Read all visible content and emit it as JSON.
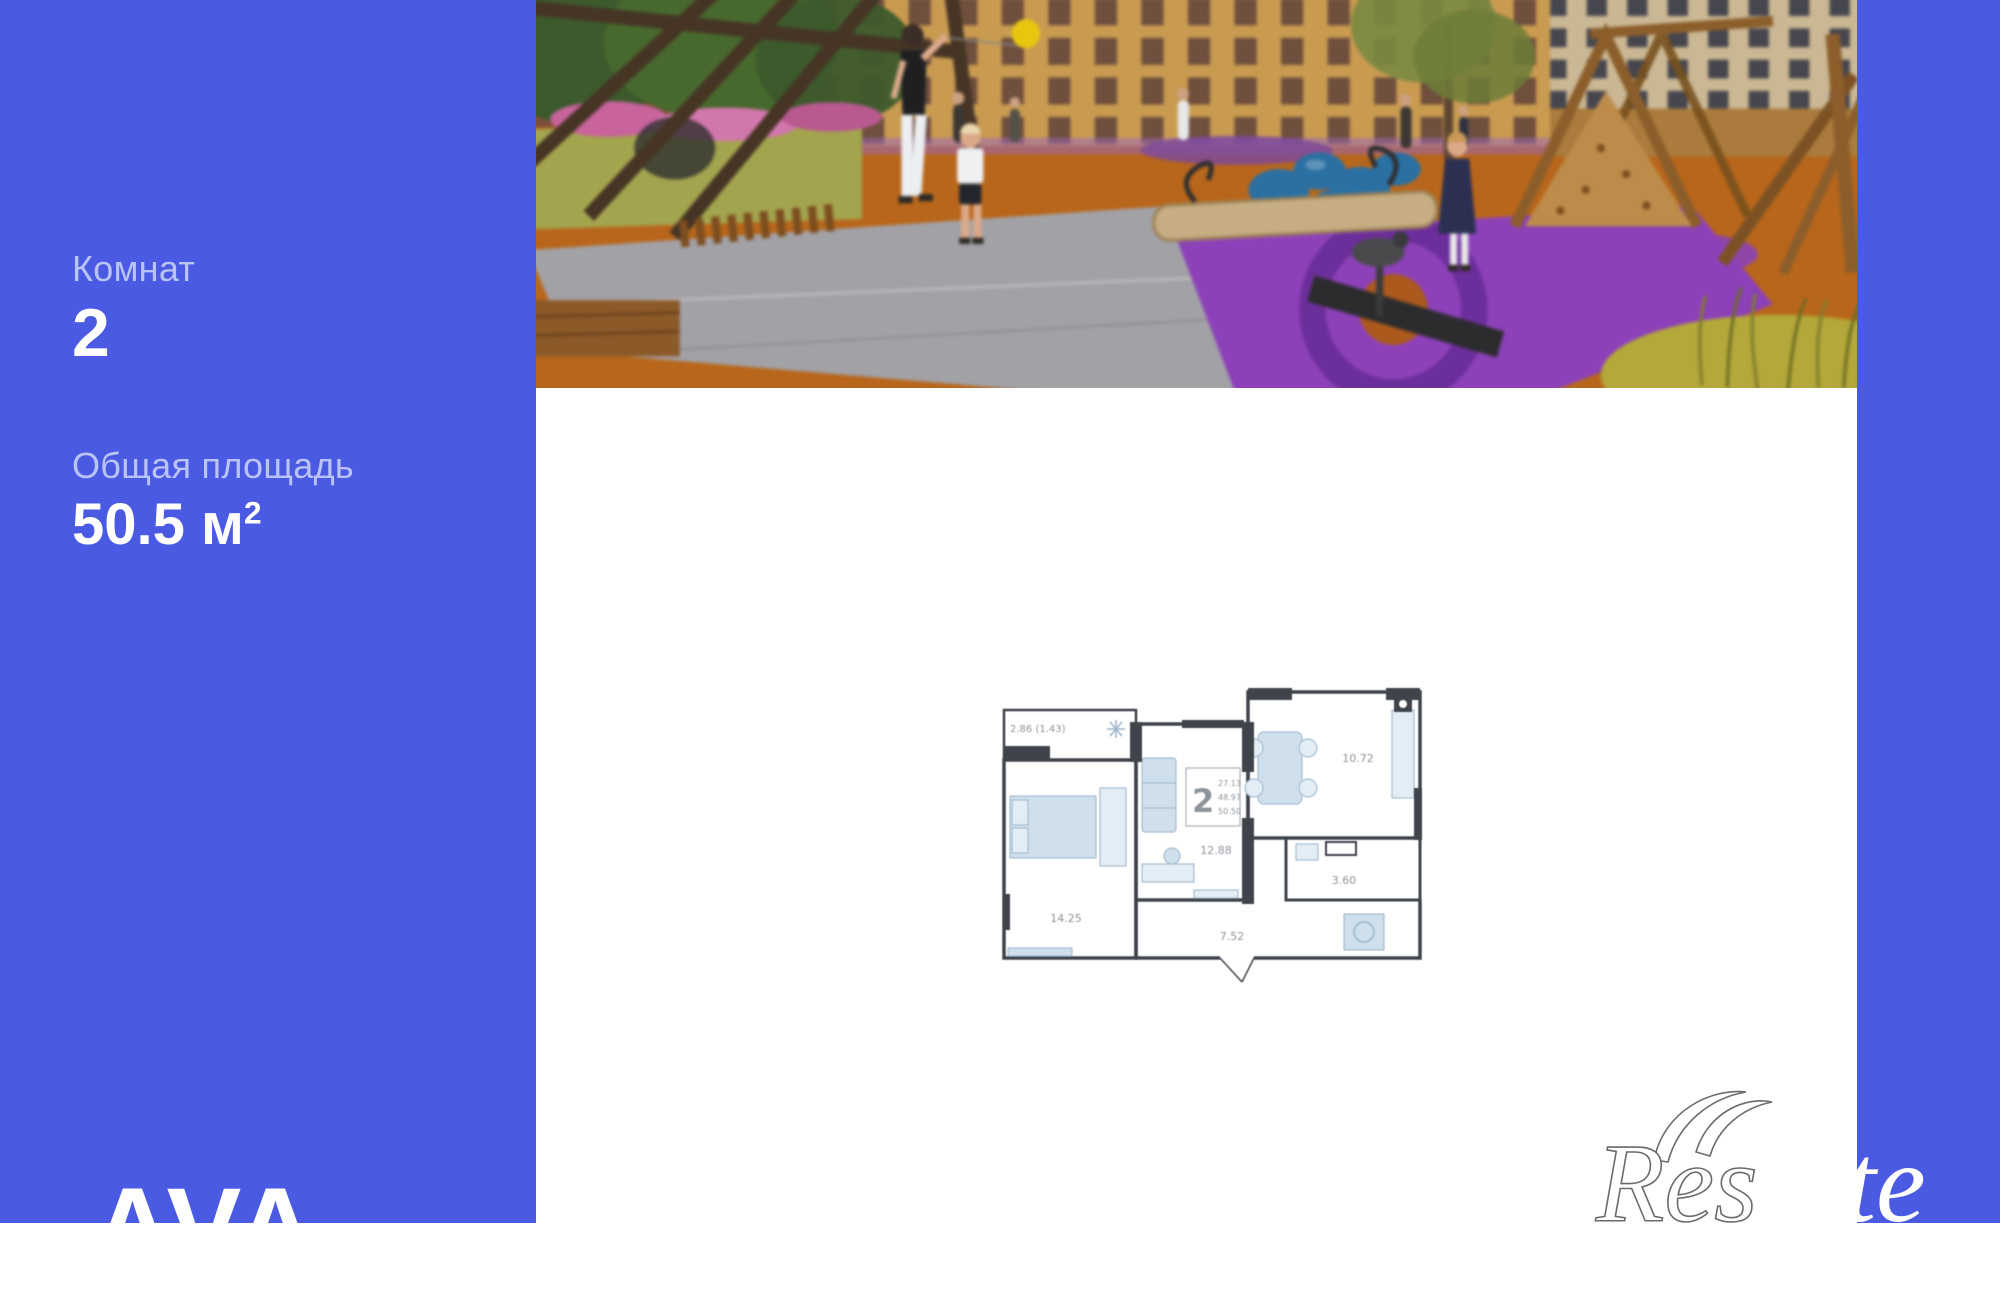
{
  "theme": {
    "accent_blue": "#4b5ae2",
    "sidebar_label_color": "#b9c3f4",
    "sidebar_value_color": "#ffffff",
    "plan_wall_color": "#3f444b",
    "plan_furniture_color": "#cfe0ec"
  },
  "sidebar": {
    "rooms_label": "Комнат",
    "rooms_value": "2",
    "area_label": "Общая площадь",
    "area_value": "50.5 м",
    "area_superscript": "2",
    "brand_logo_text": "AVA"
  },
  "floor_plan": {
    "balcony_label": "2.86 (1.43)",
    "type_badge": {
      "rooms": "2",
      "line1": "27.13",
      "line2": "48.97",
      "line3": "50.50"
    },
    "areas": {
      "bedroom": "14.25",
      "living": "12.88",
      "kitchen": "10.72",
      "hallway": "7.52",
      "bathroom": "3.60"
    }
  },
  "watermark": {
    "outline_text": "Res",
    "solid_text": "tate"
  }
}
